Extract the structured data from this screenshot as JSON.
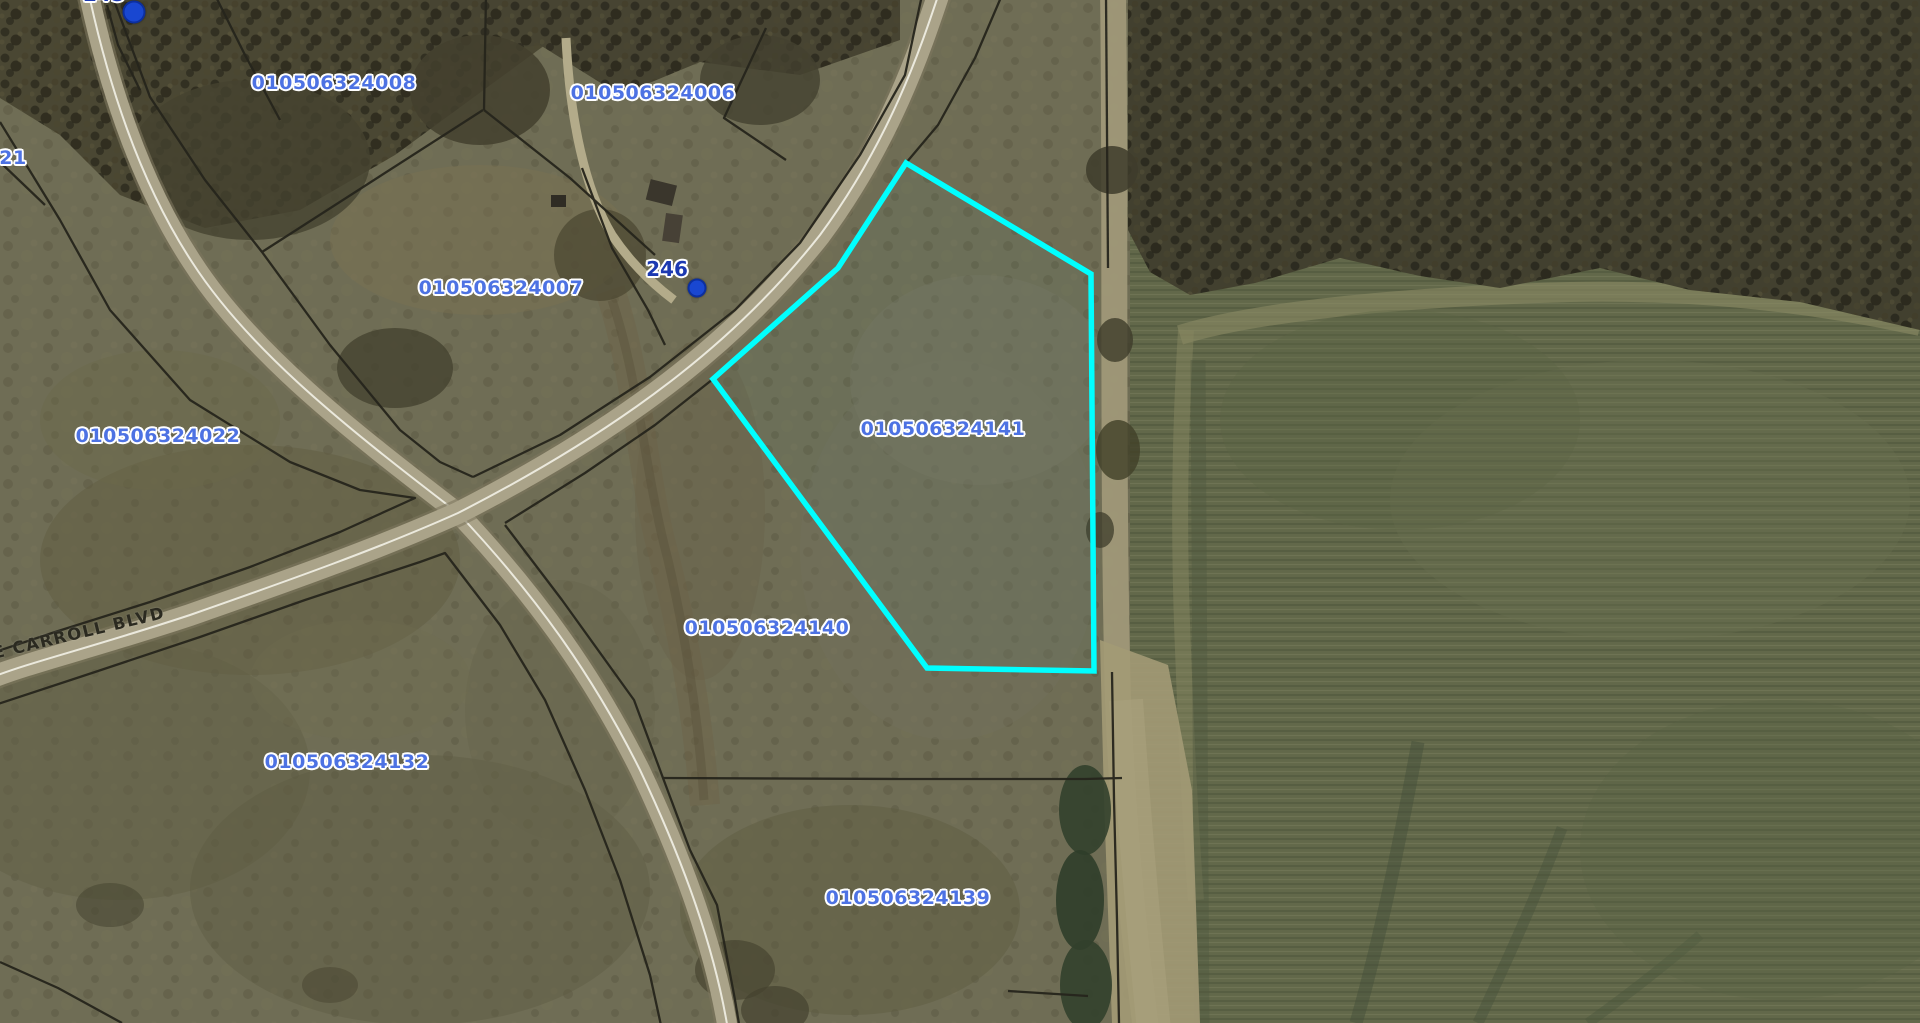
{
  "map": {
    "parcel_labels": [
      {
        "id": "010506324008",
        "partial": false
      },
      {
        "id": "010506324006",
        "partial": false
      },
      {
        "id": "010506324007",
        "partial": false
      },
      {
        "id": "010506324022",
        "partial": false
      },
      {
        "id": "010506324141",
        "partial": false,
        "highlighted": true
      },
      {
        "id": "010506324140",
        "partial": false
      },
      {
        "id": "010506324132",
        "partial": false
      },
      {
        "id": "010506324139",
        "partial": false
      },
      {
        "id": "21",
        "partial": true
      }
    ],
    "address_labels": [
      {
        "text": "246",
        "partial": false
      },
      {
        "text": "245",
        "partial": true
      }
    ],
    "road_labels": [
      {
        "text": "E CARROLL BLVD"
      }
    ],
    "highlight": {
      "parcel_id": "010506324141",
      "outline_color": "#00ffff"
    },
    "markers": [
      {
        "type": "address-point",
        "near": "245"
      },
      {
        "type": "address-point",
        "near": "246"
      }
    ],
    "colors": {
      "parcel_id_text": "#4d72e3",
      "address_text": "#1c39b1",
      "road_text": "#2b2a20",
      "highlight": "#00ffff",
      "boundary_line": "#26251c"
    }
  }
}
